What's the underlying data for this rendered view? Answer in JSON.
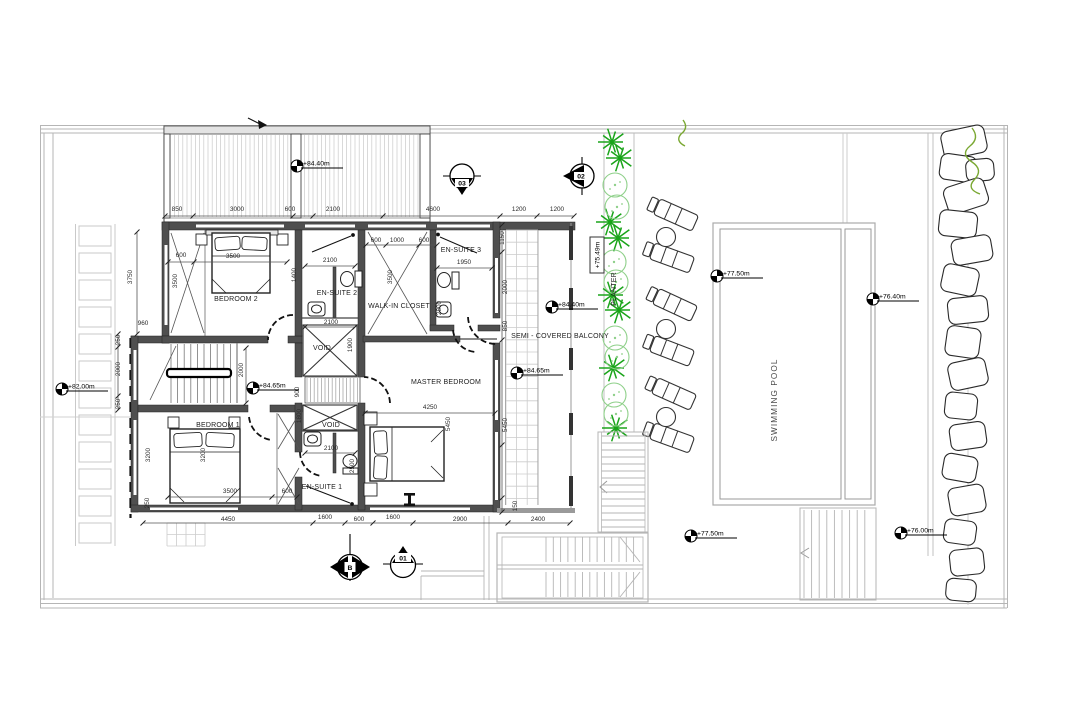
{
  "colors": {
    "wall": "#4f4f4f",
    "site_line": "#b5b5b5",
    "tile_line": "#cccccc",
    "plant_dark": "#1aa41a",
    "plant_light": "#8fd08a",
    "vine_green": "#7aa832",
    "text": "#2a2a2a"
  },
  "rooms": [
    {
      "label": "BEDROOM 2",
      "x": 236,
      "y": 301
    },
    {
      "label": "EN-SUITE 2",
      "x": 337,
      "y": 295
    },
    {
      "label": "WALK-IN CLOSET",
      "x": 399,
      "y": 308
    },
    {
      "label": "EN-SUITE 3",
      "x": 461,
      "y": 252
    },
    {
      "label": "VOID",
      "x": 322,
      "y": 350
    },
    {
      "label": "VOID",
      "x": 331,
      "y": 427
    },
    {
      "label": "BEDROOM 1",
      "x": 218,
      "y": 427
    },
    {
      "label": "EN-SUITE 1",
      "x": 322,
      "y": 489
    },
    {
      "label": "MASTER BEDROOM",
      "x": 446,
      "y": 384
    },
    {
      "label": "SEMI - COVERED BALCONY",
      "x": 560,
      "y": 338
    },
    {
      "label": "PLANTER",
      "x": 616,
      "y": 289,
      "rotate": true
    },
    {
      "label": "SWIMMING POOL",
      "x": 777,
      "y": 400,
      "rotate": true,
      "style": "pool"
    }
  ],
  "dimensions": [
    {
      "t": "850",
      "x": 177,
      "y": 211
    },
    {
      "t": "3000",
      "x": 237,
      "y": 211
    },
    {
      "t": "600",
      "x": 290,
      "y": 211
    },
    {
      "t": "2100",
      "x": 333,
      "y": 211
    },
    {
      "t": "4600",
      "x": 433,
      "y": 211
    },
    {
      "t": "1200",
      "x": 519,
      "y": 211
    },
    {
      "t": "1200",
      "x": 557,
      "y": 211
    },
    {
      "t": "600",
      "x": 376,
      "y": 242
    },
    {
      "t": "1000",
      "x": 397,
      "y": 242
    },
    {
      "t": "600",
      "x": 424,
      "y": 242
    },
    {
      "t": "1950",
      "x": 464,
      "y": 264
    },
    {
      "t": "2800",
      "x": 441,
      "y": 308,
      "v": true
    },
    {
      "t": "3500",
      "x": 392,
      "y": 277,
      "v": true
    },
    {
      "t": "1150",
      "x": 504,
      "y": 238,
      "v": true
    },
    {
      "t": "2000",
      "x": 507,
      "y": 287,
      "v": true
    },
    {
      "t": "850",
      "x": 507,
      "y": 326,
      "v": true
    },
    {
      "t": "5450",
      "x": 507,
      "y": 425,
      "v": true
    },
    {
      "t": "150",
      "x": 517,
      "y": 506,
      "v": true
    },
    {
      "t": "5450",
      "x": 450,
      "y": 424,
      "v": true
    },
    {
      "t": "4250",
      "x": 430,
      "y": 409
    },
    {
      "t": "600",
      "x": 181,
      "y": 257
    },
    {
      "t": "3500",
      "x": 233,
      "y": 258
    },
    {
      "t": "3500",
      "x": 177,
      "y": 281,
      "v": true
    },
    {
      "t": "3750",
      "x": 132,
      "y": 277,
      "v": true
    },
    {
      "t": "960",
      "x": 143,
      "y": 325
    },
    {
      "t": "2100",
      "x": 330,
      "y": 262
    },
    {
      "t": "1400",
      "x": 296,
      "y": 275,
      "v": true
    },
    {
      "t": "2100",
      "x": 331,
      "y": 324
    },
    {
      "t": "1900",
      "x": 352,
      "y": 345,
      "v": true
    },
    {
      "t": "900",
      "x": 299,
      "y": 392,
      "v": true
    },
    {
      "t": "1800",
      "x": 301,
      "y": 416,
      "v": true
    },
    {
      "t": "2000",
      "x": 243,
      "y": 370,
      "v": true
    },
    {
      "t": "250",
      "x": 120,
      "y": 340,
      "v": true
    },
    {
      "t": "2000",
      "x": 120,
      "y": 369,
      "v": true
    },
    {
      "t": "250",
      "x": 120,
      "y": 404,
      "v": true
    },
    {
      "t": "3200",
      "x": 150,
      "y": 455,
      "v": true
    },
    {
      "t": "3200",
      "x": 205,
      "y": 455,
      "v": true
    },
    {
      "t": "2100",
      "x": 331,
      "y": 450
    },
    {
      "t": "2500",
      "x": 354,
      "y": 466,
      "v": true
    },
    {
      "t": "3500",
      "x": 230,
      "y": 493
    },
    {
      "t": "600",
      "x": 287,
      "y": 493
    },
    {
      "t": "250",
      "x": 149,
      "y": 503,
      "v": true
    },
    {
      "t": "4450",
      "x": 228,
      "y": 521
    },
    {
      "t": "1600",
      "x": 325,
      "y": 519
    },
    {
      "t": "600",
      "x": 359,
      "y": 521
    },
    {
      "t": "1600",
      "x": 393,
      "y": 519
    },
    {
      "t": "2900",
      "x": 460,
      "y": 521
    },
    {
      "t": "2400",
      "x": 538,
      "y": 521
    }
  ],
  "elevations": [
    {
      "label": "+84.40m",
      "x": 297,
      "y": 166
    },
    {
      "label": "+84.40m",
      "x": 552,
      "y": 307
    },
    {
      "label": "+84.65m",
      "x": 517,
      "y": 373
    },
    {
      "label": "+84.65m",
      "x": 253,
      "y": 388
    },
    {
      "label": "+82.00m",
      "x": 62,
      "y": 389
    },
    {
      "label": "+77.50m",
      "x": 717,
      "y": 276
    },
    {
      "label": "+76.40m",
      "x": 873,
      "y": 299
    },
    {
      "label": "+77.50m",
      "x": 691,
      "y": 536
    },
    {
      "label": "+76.00m",
      "x": 901,
      "y": 533
    }
  ],
  "boxed_elevation": {
    "label": "+75.49m",
    "x": 597,
    "y": 255
  },
  "section_markers": [
    {
      "label": "03",
      "x": 462,
      "y": 176,
      "type": "down"
    },
    {
      "label": "02",
      "x": 582,
      "y": 176,
      "type": "left"
    },
    {
      "label": "B",
      "x": 350,
      "y": 567,
      "type": "leftright"
    },
    {
      "label": "01",
      "x": 403,
      "y": 565,
      "type": "up"
    }
  ]
}
